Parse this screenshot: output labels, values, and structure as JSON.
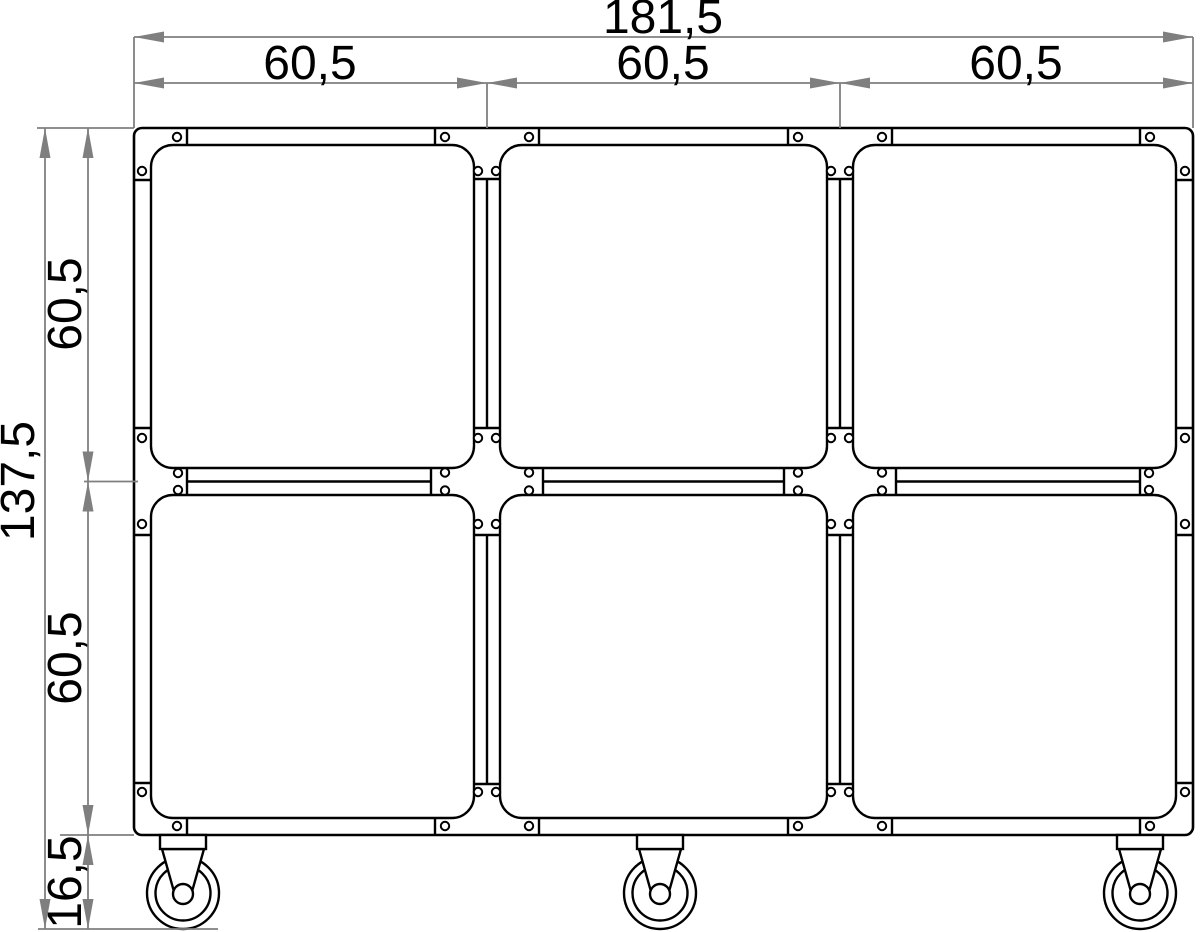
{
  "drawing": {
    "kind": "dimensioned technical drawing of a 3x2 cube shelf trolley on casters",
    "dimensions": {
      "total_width": "181,5",
      "column_widths": [
        "60,5",
        "60,5",
        "60,5"
      ],
      "total_height": "137,5",
      "row_heights": [
        "60,5",
        "60,5"
      ],
      "caster_height": "16,5"
    },
    "counts": {
      "cells": 6,
      "casters": 3
    },
    "colors": {
      "line": "#000000",
      "dimension_line": "#7f7f7f",
      "background": "#ffffff"
    }
  }
}
